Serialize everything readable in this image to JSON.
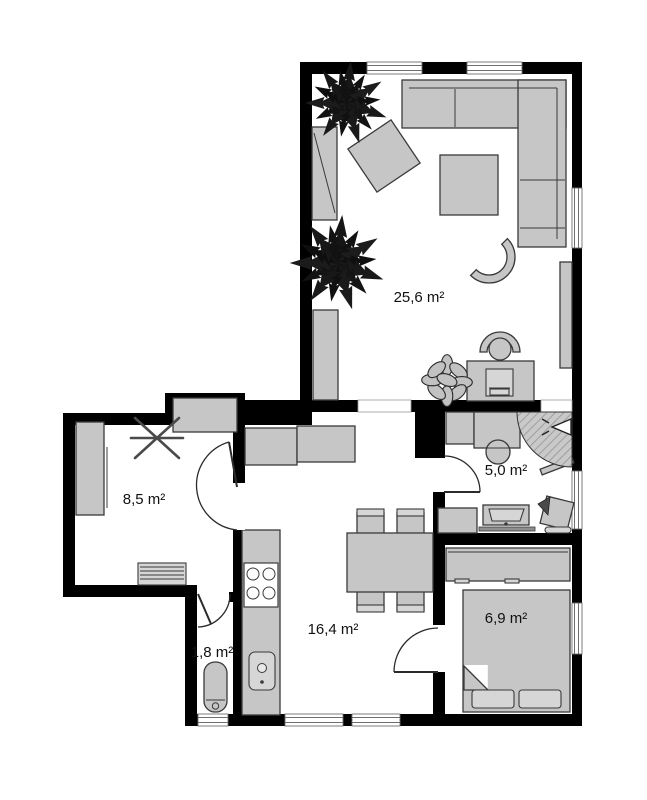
{
  "floorplan": {
    "rooms": [
      {
        "name": "living-room",
        "area_label": "25,6 m²"
      },
      {
        "name": "room-8-5",
        "area_label": "8,5 m²"
      },
      {
        "name": "hallway",
        "area_label": "5,0 m²"
      },
      {
        "name": "kitchen-dining",
        "area_label": "16,4 m²"
      },
      {
        "name": "wc",
        "area_label": "1,8 m²"
      },
      {
        "name": "bedroom",
        "area_label": "6,9 m²"
      }
    ],
    "colors": {
      "wall": "#000000",
      "furniture": "#c6c6c6",
      "outline": "#3a3a3a",
      "floor": "#ffffff",
      "plant": "#161616"
    }
  }
}
